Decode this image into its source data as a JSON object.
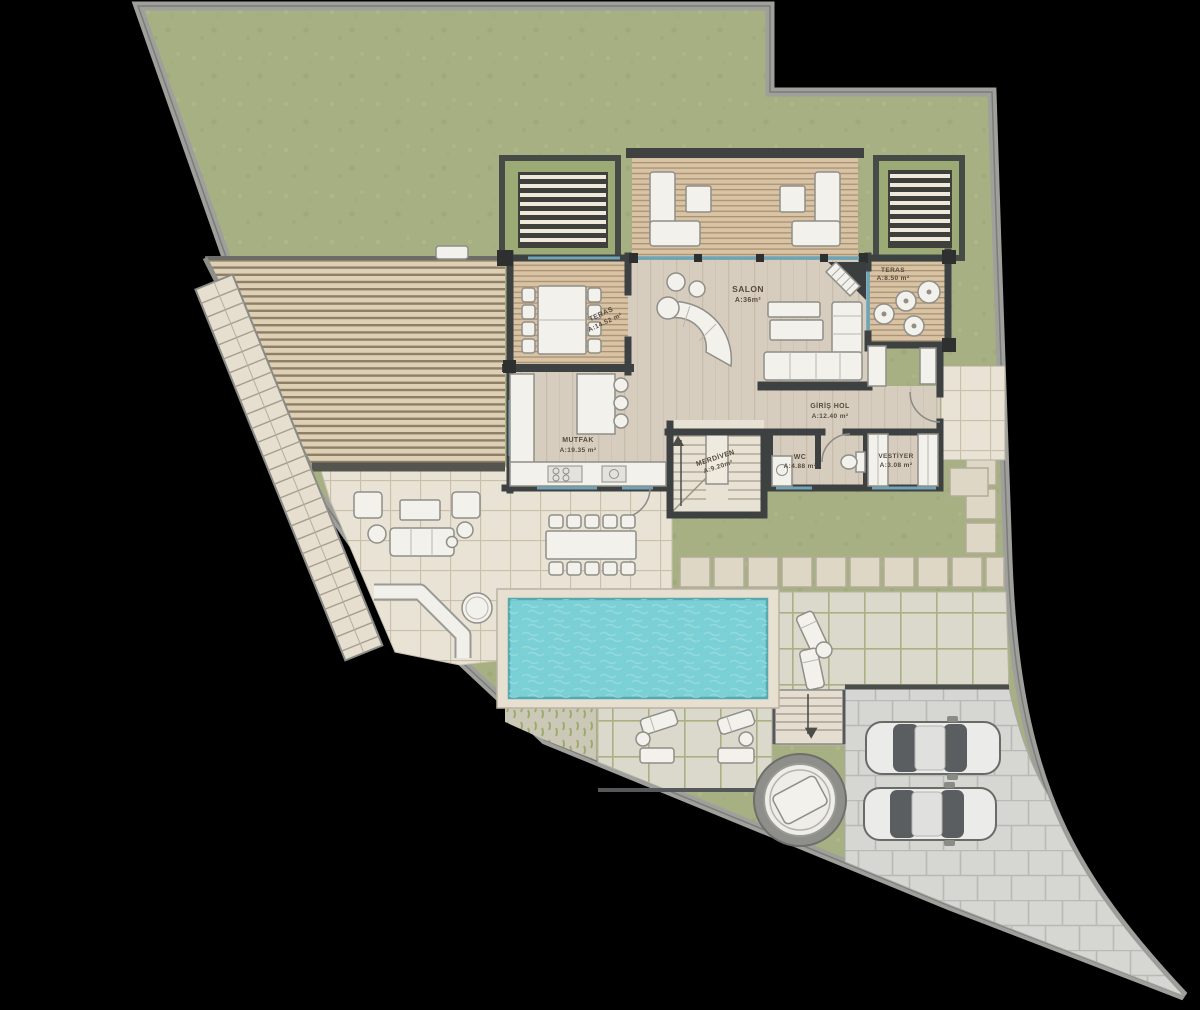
{
  "plan": {
    "rooms": {
      "salon": {
        "name": "SALON",
        "area": "A:36m²"
      },
      "teras_salon": {
        "name": "TERAS",
        "area": "A:8.50 m²"
      },
      "teras_yemek": {
        "name": "TERAS",
        "area": "A:14.52 m²"
      },
      "mutfak": {
        "name": "MUTFAK",
        "area": "A:19.35 m²"
      },
      "merdiven": {
        "name": "MERDİVEN",
        "area": "A:9.20m²"
      },
      "giris_hol": {
        "name": "GİRİŞ HOL",
        "area": "A:12.40 m²"
      },
      "wc": {
        "name": "WC",
        "area": "A:4.88 m²"
      },
      "vestiyer": {
        "name": "VESTİYER",
        "area": "A:3.08 m²"
      }
    },
    "colors": {
      "background": "#000000",
      "grass": "#a6b083",
      "boundary_wall": "#9f9f9c",
      "deck_wood": "#d8c3a4",
      "interior_floor": "#d7cdbe",
      "wall": "#3d4141",
      "glass": "#6fa3b8",
      "pool_water": "#7bd0d5",
      "stone_terrace": "#e9e3d6",
      "pale_paver": "#dbd8cc",
      "parking_paver": "#d6d6d3",
      "furniture": "#f3f1ec"
    }
  }
}
